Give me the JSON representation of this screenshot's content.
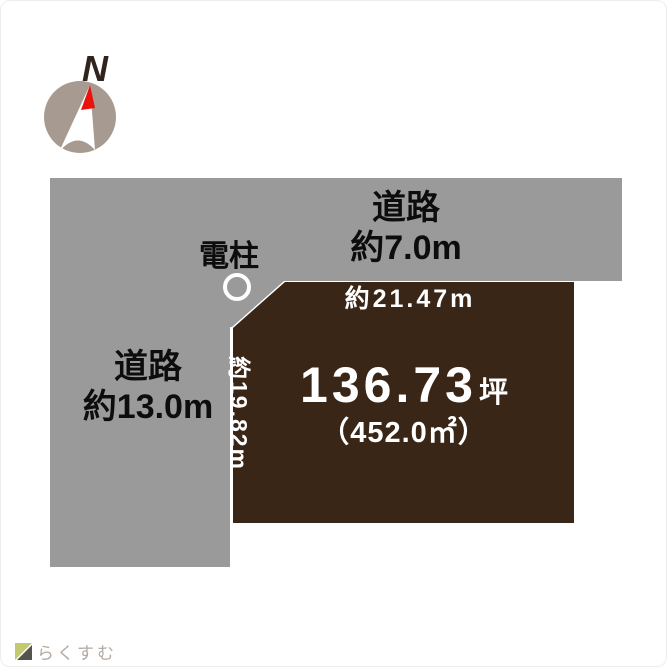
{
  "compass": {
    "north_label": "N"
  },
  "roads": {
    "top": {
      "name": "道路",
      "width": "約7.0m"
    },
    "left": {
      "name": "道路",
      "width": "約13.0m"
    }
  },
  "utility_pole": {
    "label": "電柱"
  },
  "plot": {
    "frontage": "約21.47m",
    "depth": "約19.82m",
    "area_tsubo": "136.73",
    "area_tsubo_unit": "坪",
    "area_sqm": "（452.0㎡）"
  },
  "logo": {
    "text": "らくすむ"
  },
  "colors": {
    "road_gray": "#9a9a9a",
    "plot_brown": "#3a2617",
    "compass_taupe": "#a79a91",
    "needle_white": "#ffffff",
    "needle_red": "#e8130b",
    "pole_ring": "#ffffff",
    "logo_roof": "#c3c96e",
    "logo_body": "#55534e"
  }
}
